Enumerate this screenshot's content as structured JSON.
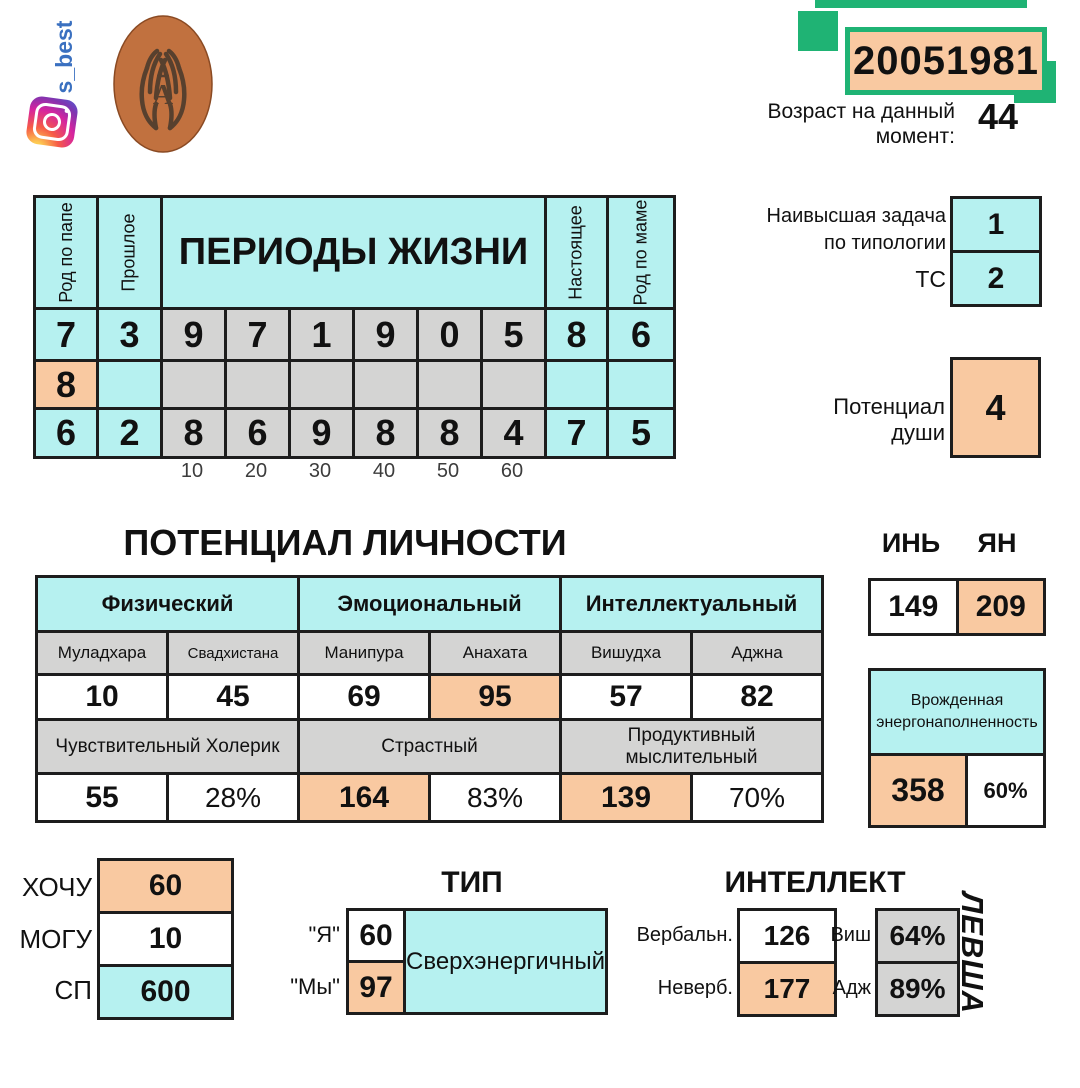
{
  "branding": {
    "handle": "s_best",
    "logo_letter": "А"
  },
  "header": {
    "birth_date": "20051981",
    "age_label": "Возраст на данный момент:",
    "age_value": "44"
  },
  "typology": {
    "task_label": "Наивысшая задача по типологии",
    "task_value": "1",
    "ts_label": "ТС",
    "ts_value": "2",
    "soul_label": "Потенциал души",
    "soul_value": "4"
  },
  "life_periods": {
    "title": "ПЕРИОДЫ ЖИЗНИ",
    "father_label": "Род по папе",
    "past_label": "Прошлое",
    "present_label": "Настоящее",
    "mother_label": "Род по маме",
    "row_top": [
      "7",
      "3",
      "9",
      "7",
      "1",
      "9",
      "0",
      "5",
      "8",
      "6"
    ],
    "row_mid_first": "8",
    "row_bottom": [
      "6",
      "2",
      "8",
      "6",
      "9",
      "8",
      "8",
      "4",
      "7",
      "5"
    ],
    "decades": [
      "10",
      "20",
      "30",
      "40",
      "50",
      "60"
    ]
  },
  "personality": {
    "title": "ПОТЕНЦИАЛ ЛИЧНОСТИ",
    "groups": [
      "Физический",
      "Эмоциональный",
      "Интеллектуальный"
    ],
    "chakras": [
      "Муладхара",
      "Свадхистана",
      "Манипура",
      "Анахата",
      "Вишудха",
      "Аджна"
    ],
    "chakra_values": [
      "10",
      "45",
      "69",
      "95",
      "57",
      "82"
    ],
    "temperaments": [
      "Чувствительный Холерик",
      "Страстный",
      "Продуктивный мыслительный"
    ],
    "totals": [
      "55",
      "28%",
      "164",
      "83%",
      "139",
      "70%"
    ]
  },
  "yin_yang": {
    "yin_label": "ИНЬ",
    "yang_label": "ЯН",
    "yin_value": "149",
    "yang_value": "209"
  },
  "energy": {
    "label": "Врожденная энергонаполненность",
    "value": "358",
    "percent": "60%"
  },
  "resources": {
    "rows": [
      {
        "label": "ХОЧУ",
        "value": "60"
      },
      {
        "label": "МОГУ",
        "value": "10"
      },
      {
        "label": "СП",
        "value": "600"
      }
    ]
  },
  "type_block": {
    "title": "ТИП",
    "i_label": "\"Я\"",
    "i_value": "60",
    "we_label": "\"Мы\"",
    "we_value": "97",
    "type_name": "Сверхэнергичный"
  },
  "intellect": {
    "title": "ИНТЕЛЛЕКТ",
    "verbal_label": "Вербальн.",
    "verbal_value": "126",
    "nonverbal_label": "Неверб.",
    "nonverbal_value": "177",
    "vishudha_label": "Виш",
    "vishudha_value": "64%",
    "ajna_label": "Адж",
    "ajna_value": "89%",
    "handedness": "ЛЕВША"
  }
}
